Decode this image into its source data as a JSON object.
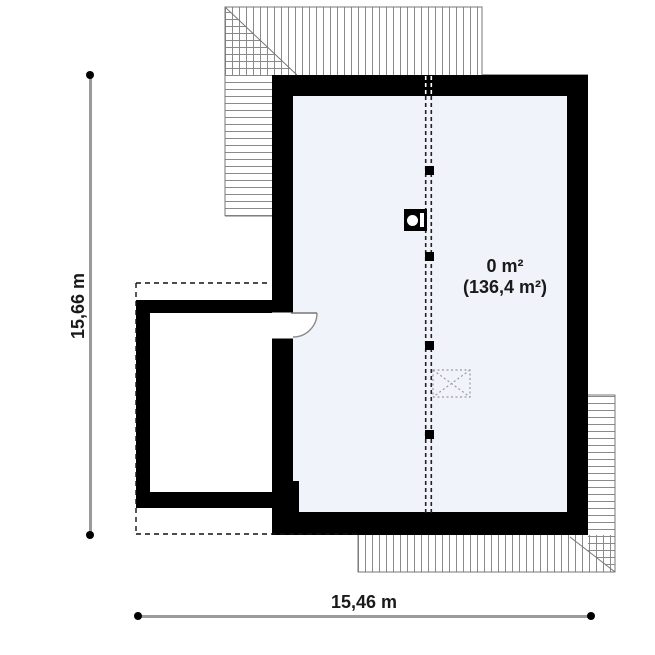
{
  "plan": {
    "room": {
      "area_label_line1": "0 m²",
      "area_label_line2": "(136,4 m²)"
    },
    "dimensions": {
      "vertical_label": "15,66 m",
      "horizontal_label": "15,46 m"
    },
    "symbols": {
      "chimney": "chimney-symbol",
      "roof_window": "roof-window-symbol",
      "door": "door-swing-symbol",
      "ridge_posts": "roof-post-markers"
    },
    "colors": {
      "wall": "#000000",
      "main_room_fill": "#f0f3fa",
      "small_room_fill": "#ffffff",
      "hatch_line": "#8a8a8a",
      "dimension_line": "#9b9b9b",
      "text": "#1a1a1a"
    }
  }
}
